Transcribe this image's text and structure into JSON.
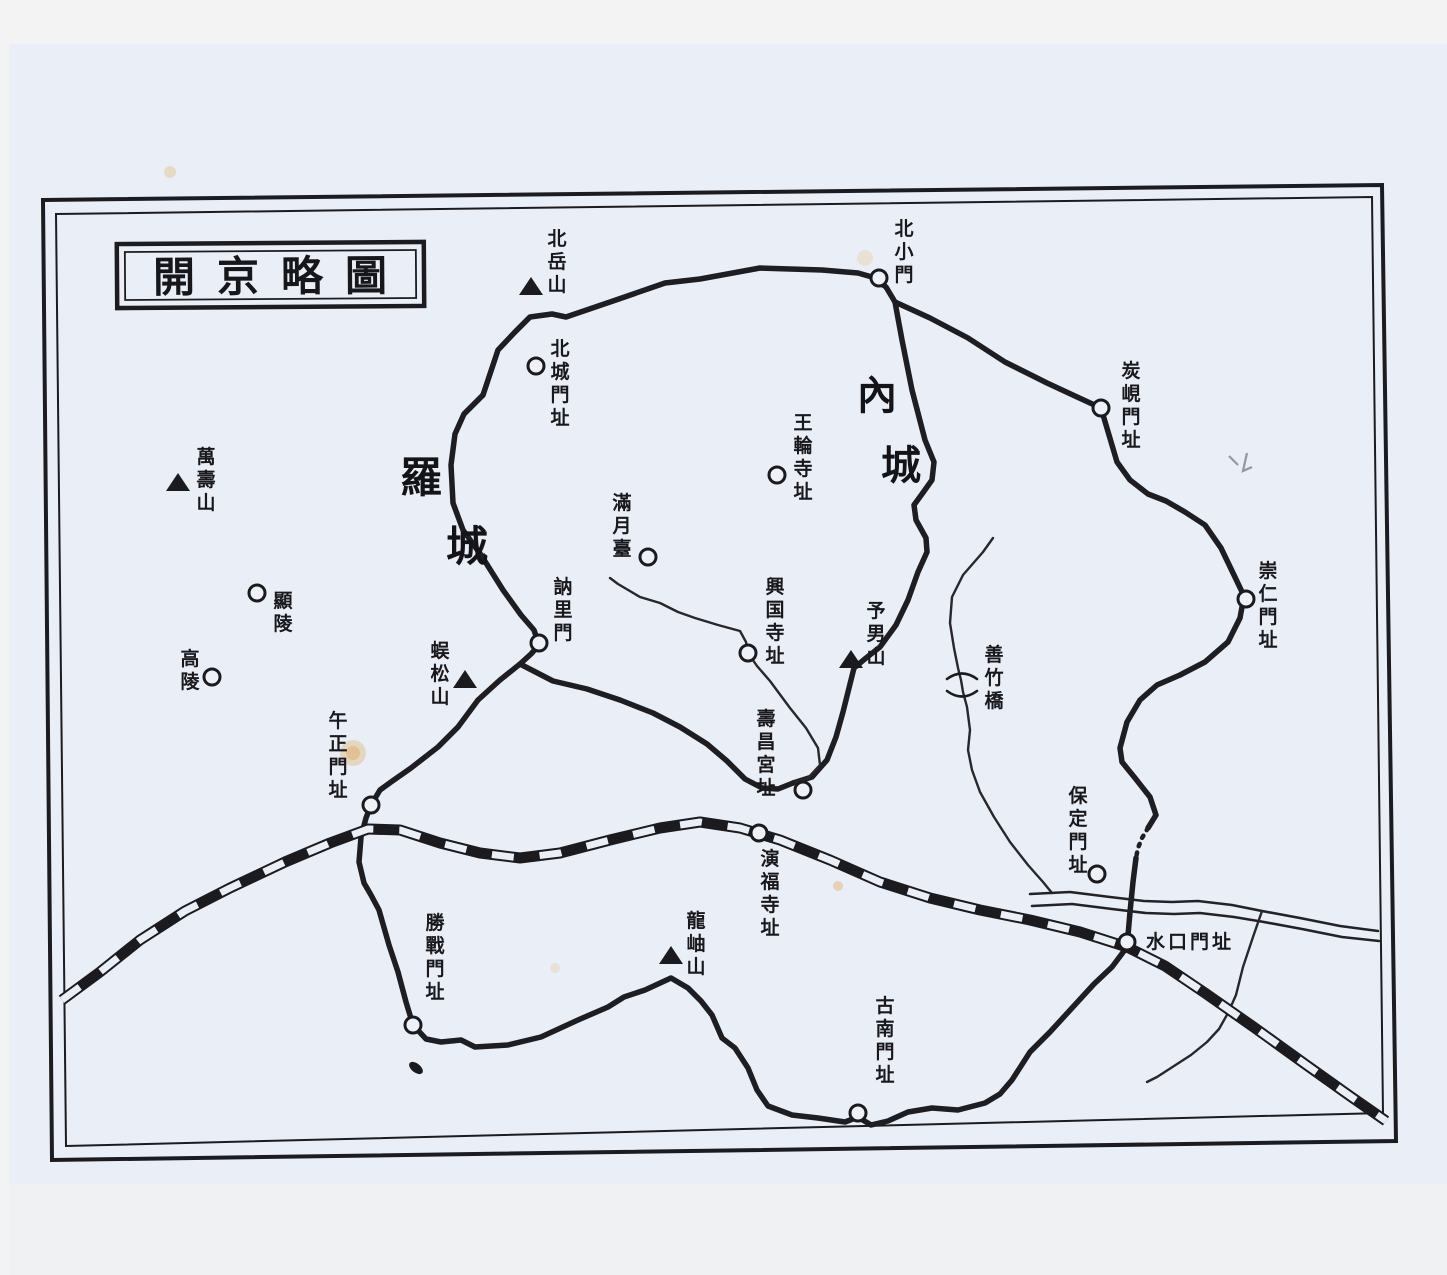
{
  "map": {
    "title": {
      "text": "開京略圖"
    },
    "regions": [
      {
        "id": "inner-capital-wall",
        "text": "內城",
        "size": 40,
        "chars": [
          [
            877,
            409
          ],
          [
            901,
            479
          ]
        ]
      },
      {
        "id": "outer-capital-wall",
        "text": "羅城",
        "size": 42,
        "chars": [
          [
            421,
            492
          ],
          [
            467,
            561
          ]
        ]
      }
    ],
    "labels": [
      {
        "id": "bugaksan-mountain",
        "text": "北岳山",
        "orient": "v",
        "x": 557,
        "y": 228,
        "marker": "triangle",
        "mx": 531,
        "my": 288
      },
      {
        "id": "buksomun-gate",
        "text": "北小門",
        "orient": "v",
        "x": 904,
        "y": 218,
        "marker": "circle",
        "mx": 879,
        "my": 278
      },
      {
        "id": "bukseongmun-gate-site",
        "text": "北城門址",
        "orient": "v",
        "x": 560,
        "y": 338,
        "marker": "circle",
        "mx": 536,
        "my": 366
      },
      {
        "id": "tanhyeon-gate-site",
        "text": "炭峴門址",
        "orient": "v",
        "x": 1131,
        "y": 360,
        "marker": "circle",
        "mx": 1101,
        "my": 408
      },
      {
        "id": "wangnyun-temple-site",
        "text": "王輪寺址",
        "orient": "v",
        "x": 803,
        "y": 412,
        "marker": "circle",
        "mx": 777,
        "my": 475
      },
      {
        "id": "mansusan-mountain",
        "text": "萬壽山",
        "orient": "v",
        "x": 206,
        "y": 446,
        "marker": "triangle",
        "mx": 178,
        "my": 484
      },
      {
        "id": "manwoldae-site",
        "text": "滿月臺",
        "orient": "v",
        "x": 622,
        "y": 492,
        "marker": "circle",
        "mx": 648,
        "my": 557
      },
      {
        "id": "sungin-gate-site",
        "text": "崇仁門址",
        "orient": "v",
        "x": 1268,
        "y": 560,
        "marker": "circle",
        "mx": 1246,
        "my": 599
      },
      {
        "id": "hyeonneung-tomb",
        "text": "顯陵",
        "orient": "v",
        "x": 283,
        "y": 590,
        "marker": "circle",
        "mx": 257,
        "my": 593
      },
      {
        "id": "nullimun-gate",
        "text": "訥里門",
        "orient": "v",
        "x": 563,
        "y": 576,
        "marker": "circle",
        "mx": 539,
        "my": 643
      },
      {
        "id": "heungguk-temple-site",
        "text": "興国寺址",
        "orient": "v",
        "x": 775,
        "y": 576,
        "marker": "circle",
        "mx": 748,
        "my": 653
      },
      {
        "id": "yenamsan-mountain",
        "text": "予男山",
        "orient": "v",
        "x": 876,
        "y": 600,
        "marker": "triangle",
        "mx": 851,
        "my": 661
      },
      {
        "id": "goneung-tomb",
        "text": "高陵",
        "orient": "v",
        "x": 190,
        "y": 648,
        "marker": "circle",
        "mx": 212,
        "my": 677
      },
      {
        "id": "osongsan-mountain",
        "text": "蜈松山",
        "orient": "v",
        "x": 440,
        "y": 640,
        "marker": "triangle",
        "mx": 465,
        "my": 681
      },
      {
        "id": "seonjuk-bridge",
        "text": "善竹橋",
        "orient": "v",
        "x": 994,
        "y": 644,
        "marker": "bridge",
        "mx": 962,
        "my": 685
      },
      {
        "id": "ojeong-gate-site",
        "text": "午正門址",
        "orient": "v",
        "x": 338,
        "y": 710,
        "marker": "circle",
        "mx": 371,
        "my": 805
      },
      {
        "id": "suchang-palace-site",
        "text": "壽昌宮址",
        "orient": "v",
        "x": 766,
        "y": 708,
        "marker": "circle",
        "mx": 803,
        "my": 790
      },
      {
        "id": "bojeong-gate-site",
        "text": "保定門址",
        "orient": "v",
        "x": 1078,
        "y": 785,
        "marker": "circle",
        "mx": 1097,
        "my": 874
      },
      {
        "id": "yeonbok-temple-site",
        "text": "演福寺址",
        "orient": "v",
        "x": 770,
        "y": 848,
        "marker": "circle",
        "mx": 759,
        "my": 833
      },
      {
        "id": "sugu-gate-site",
        "text": "水口門址",
        "orient": "h",
        "x": 1146,
        "y": 948,
        "marker": "circle",
        "mx": 1127,
        "my": 942
      },
      {
        "id": "seungjeon-gate-site",
        "text": "勝戰門址",
        "orient": "v",
        "x": 435,
        "y": 912,
        "marker": "circle",
        "mx": 413,
        "my": 1025
      },
      {
        "id": "yongsusan-mountain",
        "text": "龍岫山",
        "orient": "v",
        "x": 696,
        "y": 910,
        "marker": "triangle",
        "mx": 671,
        "my": 957
      },
      {
        "id": "gonam-gate-site",
        "text": "古南門址",
        "orient": "v",
        "x": 885,
        "y": 995,
        "marker": "circle",
        "mx": 858,
        "my": 1113
      }
    ]
  },
  "colors": {
    "ink": "#1c1c20",
    "paper": "#eaeef7",
    "margin": "#f3f3f4",
    "stain": "#e0b87e"
  }
}
